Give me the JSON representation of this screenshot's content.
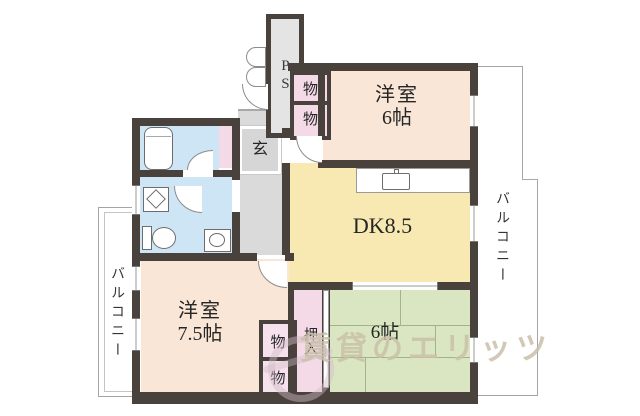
{
  "plan": {
    "labels": {
      "ps": "PS",
      "storage": "物",
      "entrance": "玄",
      "closet": "押入",
      "balcony": "バルコニー",
      "watermark": "賃貸のエリッツ"
    },
    "rooms": {
      "west6": {
        "name": "洋室",
        "size": "6帖"
      },
      "dk": {
        "name": "DK8.5"
      },
      "tatami6": {
        "name": "6帖"
      },
      "west75": {
        "name": "洋室",
        "size": "7.5帖"
      }
    },
    "colors": {
      "wall": "#49423c",
      "room_peach": "#f9e6d7",
      "room_yellow": "#f8e9b3",
      "room_green": "#dae6c2",
      "room_pink": "#f4dae6",
      "room_blue": "#cde5f4",
      "corridor_gray": "#dadada",
      "balcony_line": "#a5a5a5",
      "watermark": "#c9bfa8"
    }
  }
}
